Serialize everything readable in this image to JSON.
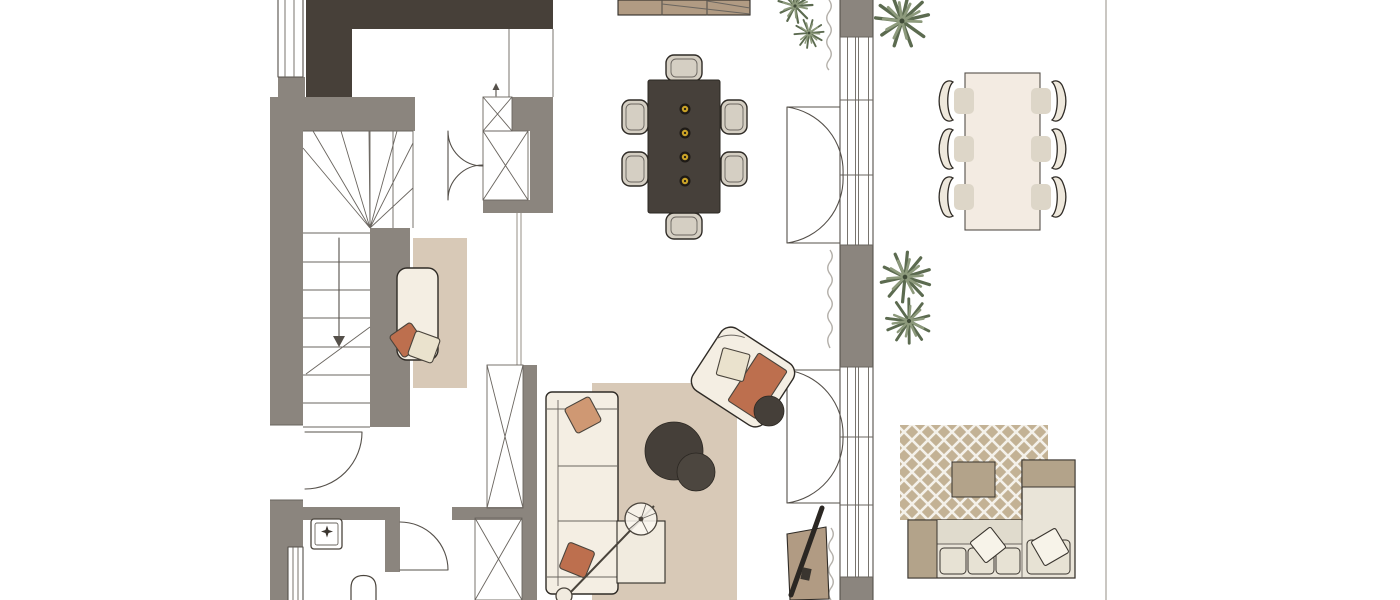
{
  "scene": {
    "title": "Furnished ground-floor interior floor plan, top view",
    "type": "floor-plan",
    "view": "top-down"
  },
  "colors": {
    "paper": "#ffffff",
    "wallDark": "#474039",
    "wallGray": "#8b857e",
    "line": "#55504a",
    "lineSoft": "#6a655f",
    "lineLight": "#b3afa9",
    "cream": "#f4eee3",
    "creamLight": "#f1ebdf",
    "tan": "#b19b83",
    "darkFurniture": "#46403a",
    "chairBeige": "#d5cfc3",
    "rugBeige": "#d8c9b7",
    "rugOutdoor": "#c3b295",
    "outdoorTan": "#b3a38a",
    "outdoorCream": "#e9e4d8",
    "terracotta": "#bd6f4e",
    "terracottaLight": "#cf9873",
    "pillowCream": "#eae2cd",
    "plantDark": "#5c6b50",
    "plantLight": "#8d9a7c",
    "brass": "#c9a227"
  },
  "legend": {
    "rooms": [
      "staircase",
      "hallway",
      "bathroom",
      "kitchen",
      "dining-area",
      "living-room",
      "terrace"
    ],
    "furniture": [
      "kitchen-island",
      "dining-table",
      "dining-chairs-x6",
      "brass-candleholders-x4",
      "hall-closet",
      "wardrobe-columns",
      "daybed-with-rug",
      "sofa",
      "ottoman",
      "round-coffee-tables-x2",
      "floor-lamp",
      "armchair",
      "round-side-table",
      "tv-console",
      "outdoor-dining-table",
      "outdoor-dining-chairs-x6",
      "outdoor-lounge-sofa",
      "outdoor-coffee-table",
      "patterned-outdoor-rug"
    ],
    "plants": 5,
    "doors": [
      "entry-door",
      "bathroom-door",
      "closet-double-doors",
      "french-doors-upper",
      "french-doors-lower"
    ],
    "windows": [
      "left-wall-window-top",
      "left-wall-window-bottom",
      "glazed-window-wall"
    ]
  }
}
